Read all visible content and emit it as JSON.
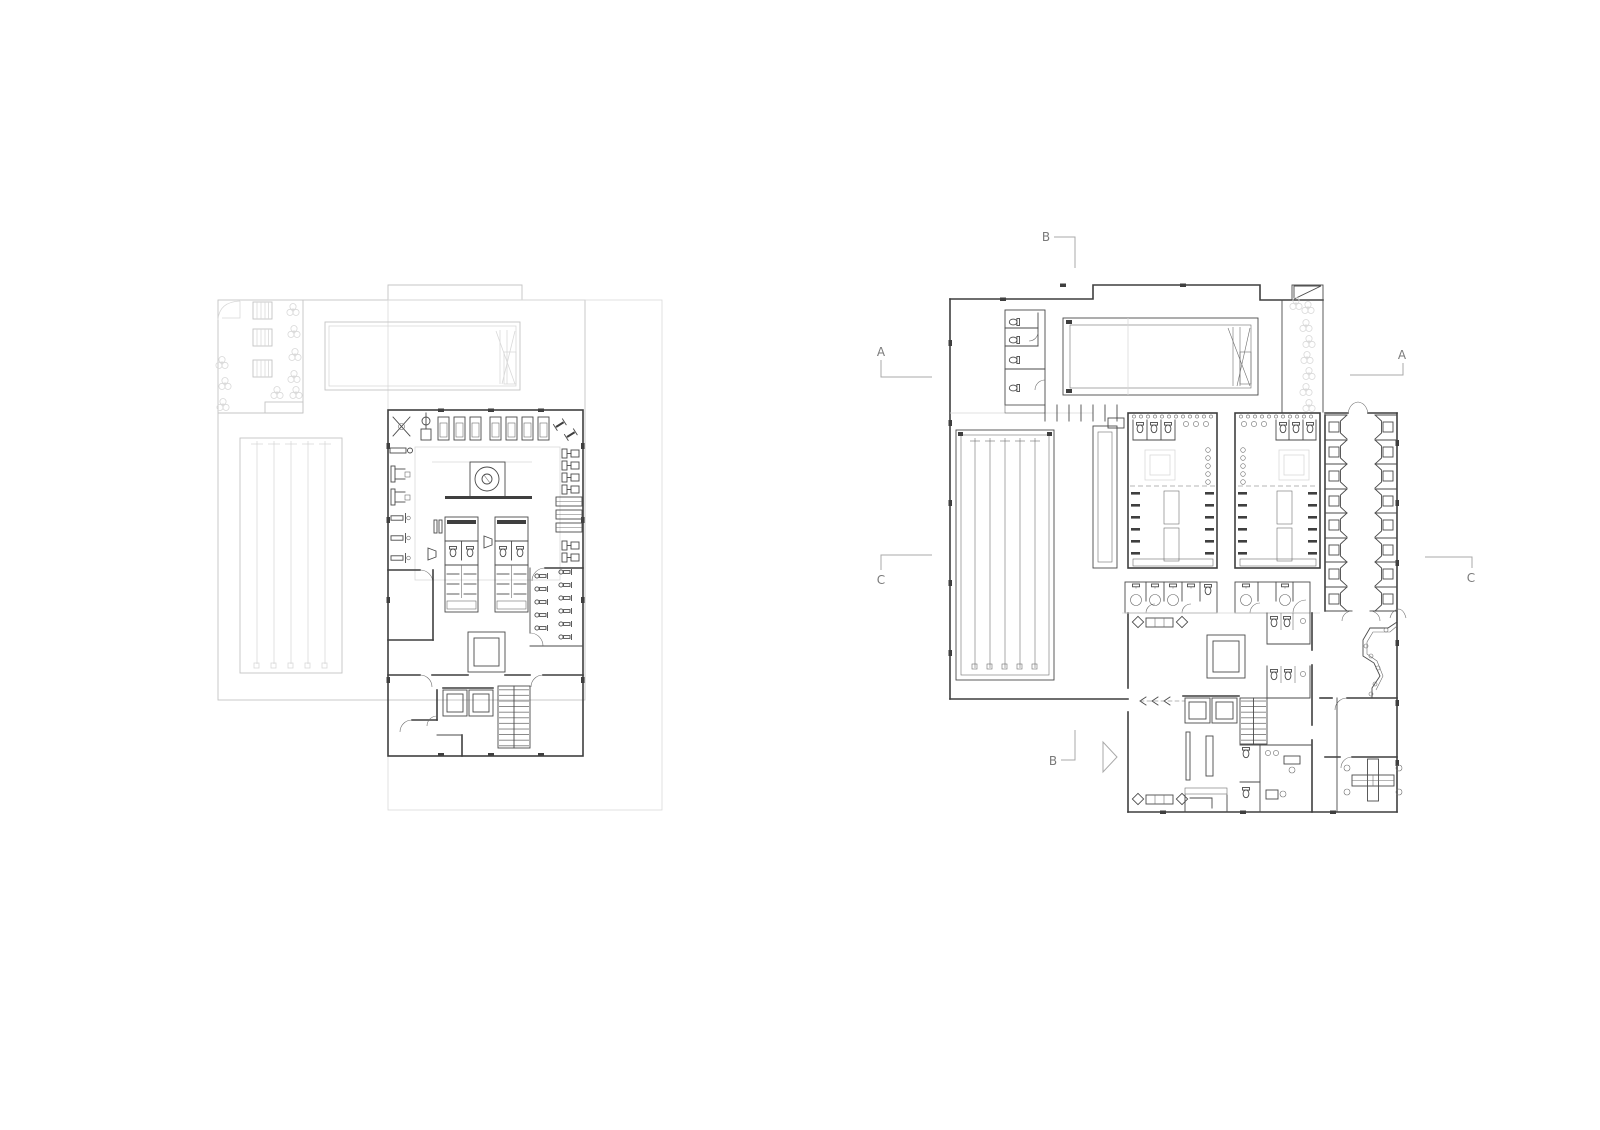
{
  "document": {
    "kind": "architectural-floor-plan-sheet",
    "background": "#ffffff",
    "plans": [
      {
        "id": "plan-left",
        "description": "upper floor plan with gym, saunas, atrium and roof/site context"
      },
      {
        "id": "plan-right",
        "description": "ground floor plan with pools, changing rooms, cabins, lobby and offices"
      }
    ]
  },
  "colors": {
    "wall_dark": "#3f3f3f",
    "line_medium": "#4a4a4a",
    "line_light": "#c4c4c4",
    "marker_gray": "#7a7a7a"
  },
  "markers": {
    "section_b_top": "B",
    "section_a_left": "A",
    "section_a_right": "A",
    "section_c_left": "C",
    "section_c_right": "C",
    "section_b_bottom": "B"
  },
  "icons": [
    "tree-icon",
    "lounge-chair-icon",
    "table-chairs-icon",
    "treadmill-icon",
    "dumbbell-icon",
    "exercise-bike-icon",
    "toilet-icon",
    "shower-icon",
    "locker-grid-icon",
    "elevator-icon",
    "stair-icon",
    "spiral-stair-icon",
    "reception-desk-icon",
    "office-desk-cluster-icon",
    "entrance-arrow-icon",
    "changing-cabin-icon",
    "bench-icon"
  ]
}
